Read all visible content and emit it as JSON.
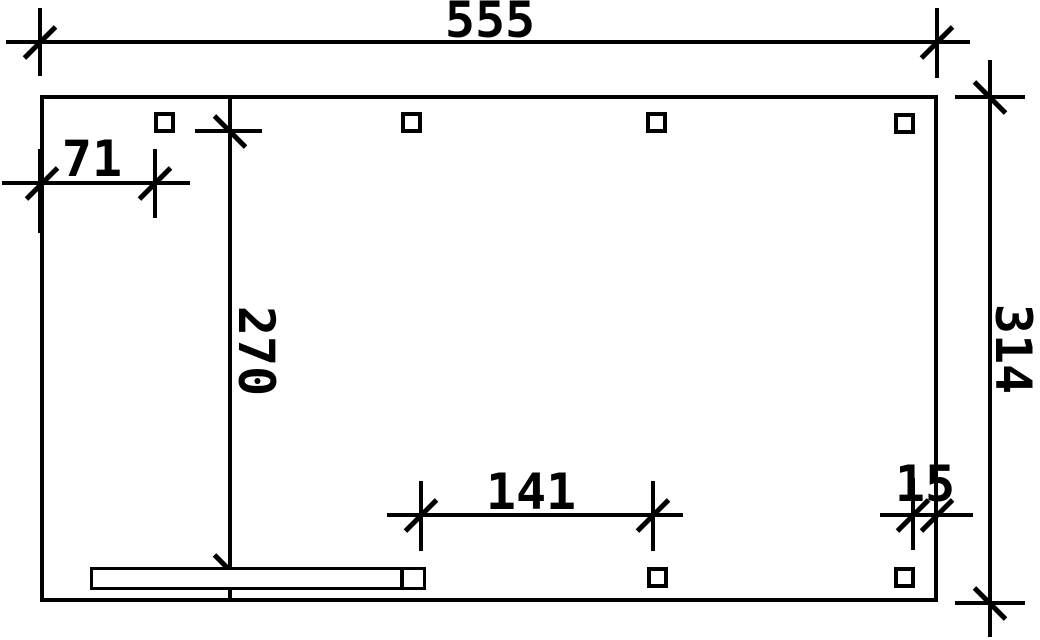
{
  "drawing": {
    "type": "technical-plan",
    "paper_color": "#ffffff",
    "line_color": "#000000",
    "dimensions": {
      "top_width": "555",
      "right_height": "314",
      "left_inset": "71",
      "inner_height": "270",
      "bottom_span": "141",
      "right_inset": "15"
    },
    "post_count_top": 4,
    "post_count_bottom": 2
  }
}
